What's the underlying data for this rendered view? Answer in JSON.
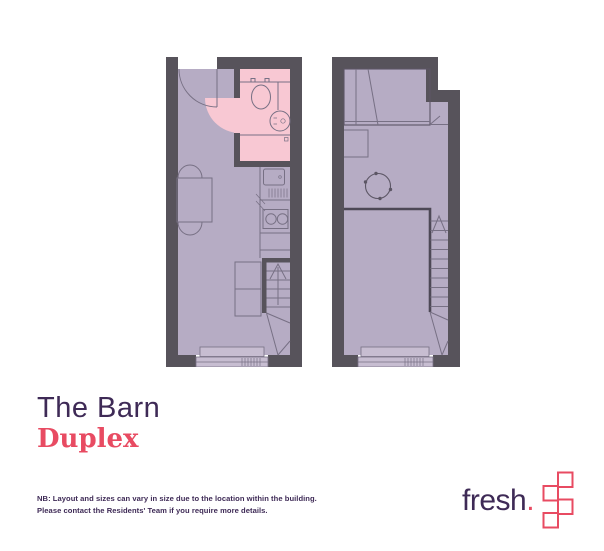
{
  "plan": {
    "property_name": "The Barn",
    "unit_type": "Duplex"
  },
  "disclaimer": {
    "line1": "NB: Layout and sizes can vary in size due to the location within the building.",
    "line2": "Please contact the Residents' Team if you require more details."
  },
  "logo": {
    "brand": "fresh",
    "dot": "."
  },
  "colors": {
    "wall": "#57535b",
    "room": "#b6acc4",
    "bathroom": "#f8c8d3",
    "window": "#c7bdd1",
    "title": "#3e2a56",
    "accent": "#e84b62",
    "line": "#777084",
    "line-dark": "#5c5665"
  }
}
